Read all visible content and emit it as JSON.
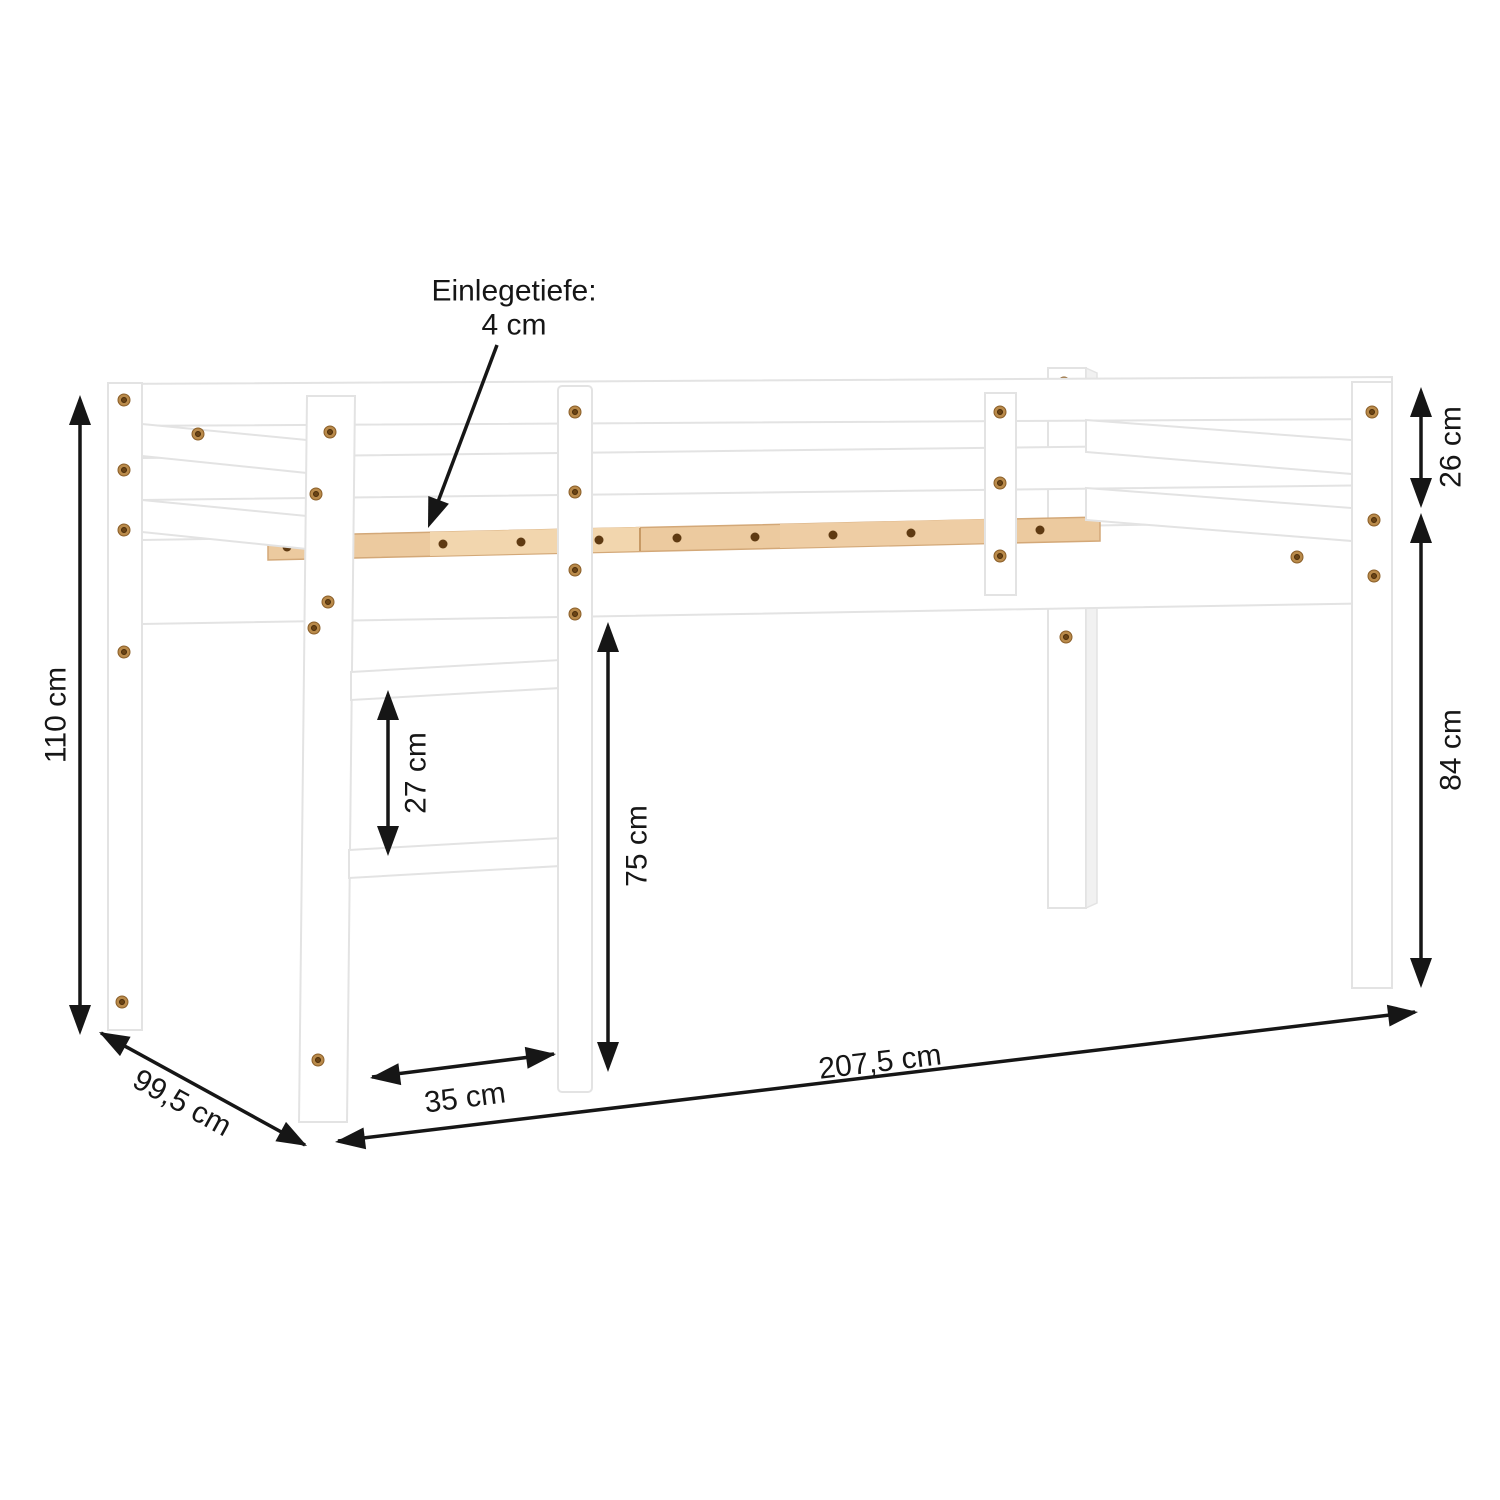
{
  "page": {
    "background": "#ffffff",
    "subject": "loft-bed-dimension-diagram"
  },
  "style": {
    "line_color": "#161616",
    "bed_color": "#ffffff",
    "bed_outline": "#e3e3e3",
    "wood_color": "#ecca9f"
  },
  "callout": {
    "line1": "Einlegetiefe:",
    "line2": "4 cm"
  },
  "dimensions": {
    "total_height": "110 cm",
    "depth": "99,5 cm",
    "length": "207,5 cm",
    "guard_rail_height": "26 cm",
    "leg_height": "84 cm",
    "rung_spacing": "27 cm",
    "under_bed_clearance": "75 cm",
    "ladder_width": "35 cm"
  }
}
